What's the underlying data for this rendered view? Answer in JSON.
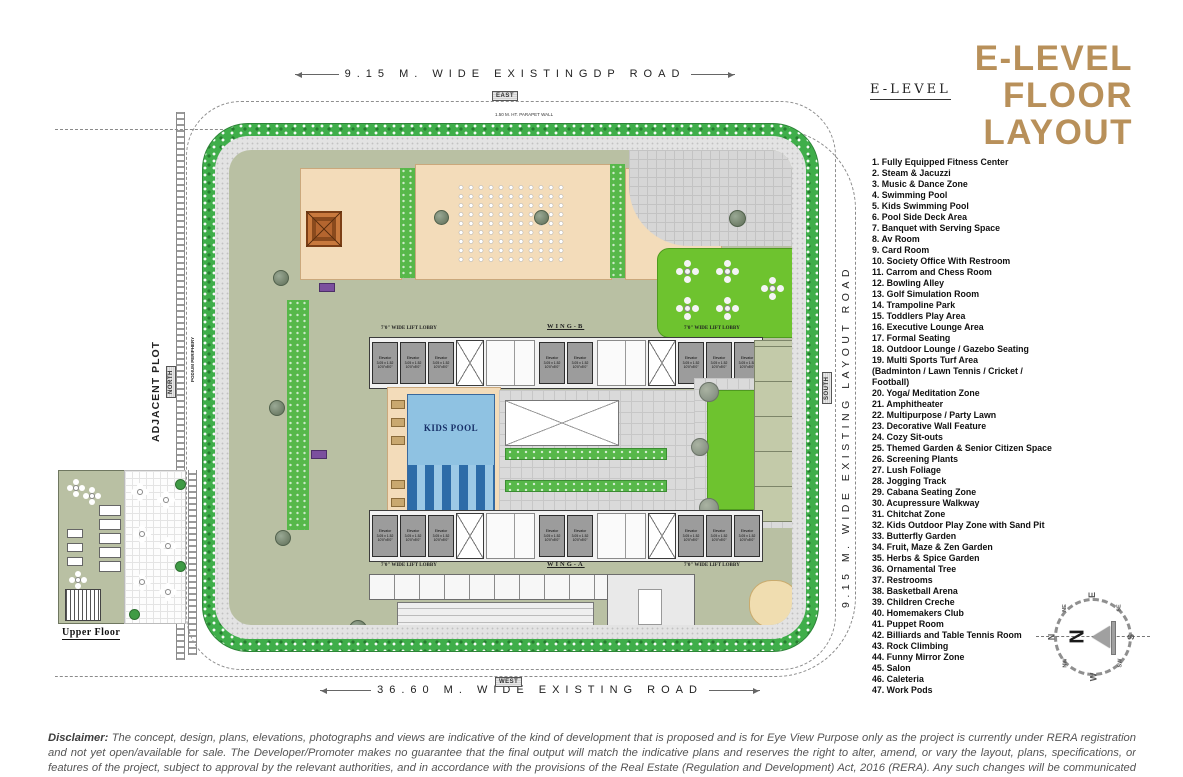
{
  "header": {
    "section_label": "E-LEVEL",
    "title_lines": [
      "E-LEVEL",
      "FLOOR",
      "LAYOUT"
    ]
  },
  "roads": {
    "top_label": "9.15 M. WIDE EXISTINGDP ROAD",
    "bottom_label": "36.60 M. WIDE EXISTING ROAD",
    "right_label": "9.15 M. WIDE EXISTING LAYOUT ROAD",
    "adjacent_plot_label": "ADJACENT PLOT",
    "podium_periphery_label": "PODIUM PERIPHERY",
    "parapet_label": "1.50 M. HT. PARAPET WALL",
    "direction_boxes": {
      "top": "EAST",
      "bottom": "WEST",
      "left": "NORTH",
      "right": "SOUTH"
    }
  },
  "legend": {
    "lines": [
      "1. Fully Equipped Fitness Center",
      "2. Steam & Jacuzzi",
      "3. Music & Dance Zone",
      "4. Swimming Pool",
      "5. Kids Swimming Pool",
      "6. Pool Side Deck Area",
      "7. Banquet with Serving Space",
      "8. Av Room",
      "9. Card Room",
      "10. Society Office With Restroom",
      "11. Carrom and Chess Room",
      "12. Bowling Alley",
      "13. Golf Simulation Room",
      "14. Trampoline Park",
      "15. Toddlers Play Area",
      "16. Executive Lounge Area",
      "17. Formal Seating",
      "18. Outdoor Lounge / Gazebo Seating",
      "19. Multi Sports Turf Area",
      "(Badminton / Lawn Tennis / Cricket /",
      "Football)",
      "20. Yoga/ Meditation Zone",
      "21. Amphitheater",
      "22. Multipurpose / Party Lawn",
      "23. Decorative Wall Feature",
      "24. Cozy Sit-outs",
      "25. Themed Garden & Senior Citizen Space",
      "26. Screening Plants",
      "27. Lush Foliage",
      "28. Jogging Track",
      "29. Cabana Seating Zone",
      "30. Acupressure Walkway",
      "31. Chitchat Zone",
      "32. Kids Outdoor Play Zone with Sand Pit",
      "33. Butterfly Garden",
      "34. Fruit, Maze & Zen Garden",
      "35. Herbs & Spice Garden",
      "36. Ornamental Tree",
      "37. Restrooms",
      "38. Basketball Arena",
      "39. Children Creche",
      "40. Homemakers Club",
      "41. Puppet Room",
      "42. Billiards and Table Tennis Room",
      "43. Rock Climbing",
      "44. Funny Mirror Zone",
      "45. Salon",
      "46. Caleteria",
      "47. Work Pods"
    ]
  },
  "plan": {
    "wing_b_label": "WING-B",
    "wing_a_label": "WING-A",
    "lift_lobby_label": "7'0\" WIDE LIFT LOBBY",
    "kids_pool_label": "KIDS POOL",
    "elevator": {
      "name": "Elevator",
      "dim_m": "3.05 x 1.52",
      "dim_ft": "10'0\"x5'0\""
    },
    "upper_floor_label": "Upper Floor"
  },
  "compass": {
    "points": [
      "E",
      "SE",
      "S",
      "SW",
      "W",
      "NW",
      "N",
      "NE"
    ],
    "needle_label": "N"
  },
  "disclaimer": {
    "label": "Disclaimer:",
    "text": "The concept, design, plans, elevations, photographs and views are indicative of the kind of development that is proposed and is for Eye View Purpose only as the project is currently under RERA registration and not yet open/available for sale. The Developer/Promoter makes no guarantee that the final output will match the indicative plans and reserves the right to alter, amend, or vary the layout, plans, specifications, or features of the project, subject to approval by the relevant authorities, and in accordance with the provisions of the Real Estate (Regulation and Development) Act, 2016 (RERA). Any such changes will be communicated to the purchasers in a timely manner, as required by RERA."
  },
  "colors": {
    "accent": "#b8905a",
    "hedge_green": "#3fae4a",
    "lawn_green": "#6ec32f",
    "deck_tan": "#f3dcba",
    "pool_blue": "#8fc2e2",
    "paver_grey": "#dadada"
  }
}
